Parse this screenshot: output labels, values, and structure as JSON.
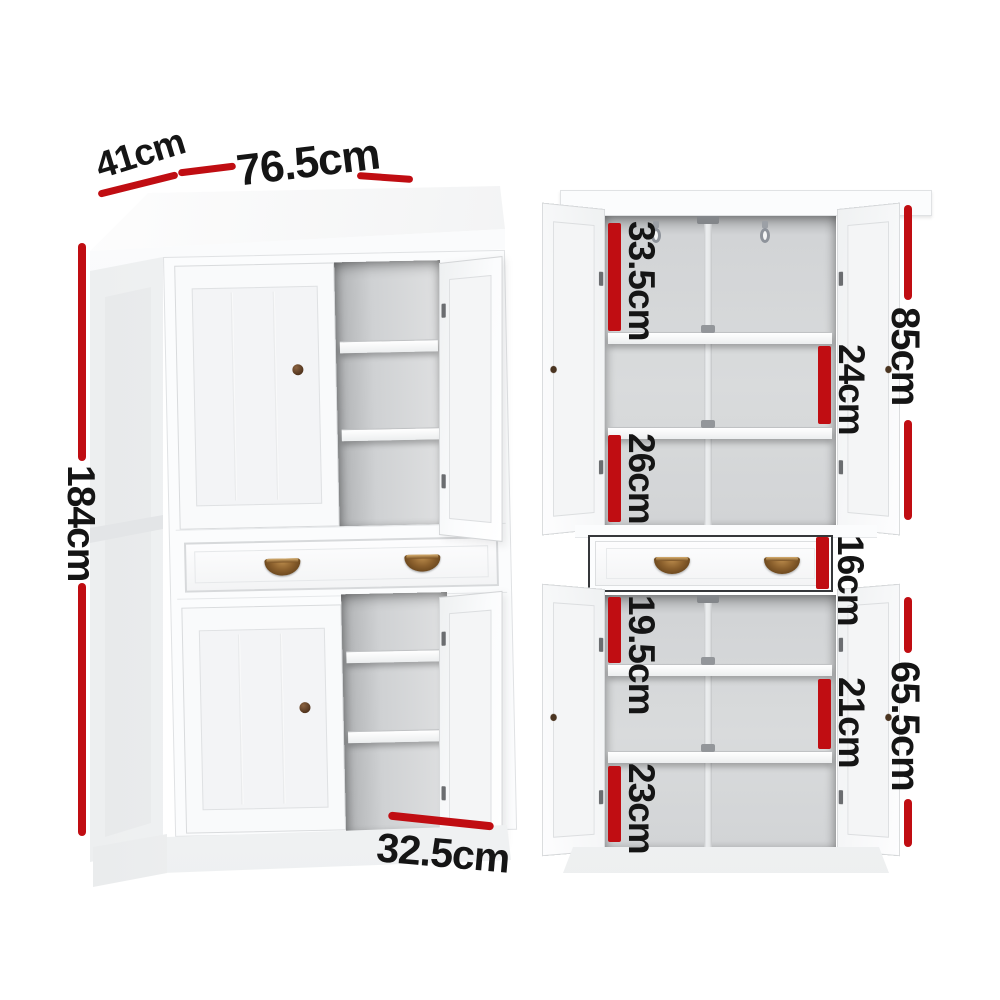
{
  "colors": {
    "accent": "#c00d12",
    "handle_bronze": "#8a5f2c",
    "cabinet_white": "#fbfcfd"
  },
  "views": {
    "angled": {
      "dims": {
        "depth": "41cm",
        "width": "76.5cm",
        "height": "184cm",
        "shelf_width": "32.5cm"
      }
    },
    "front": {
      "dims": {
        "upper_top": "33.5cm",
        "upper_middle": "24cm",
        "upper_total": "85cm",
        "upper_bottom": "26cm",
        "drawer": "16cm",
        "lower_top": "19.5cm",
        "lower_middle": "21cm",
        "lower_total": "65.5cm",
        "lower_bottom": "23cm"
      }
    }
  }
}
